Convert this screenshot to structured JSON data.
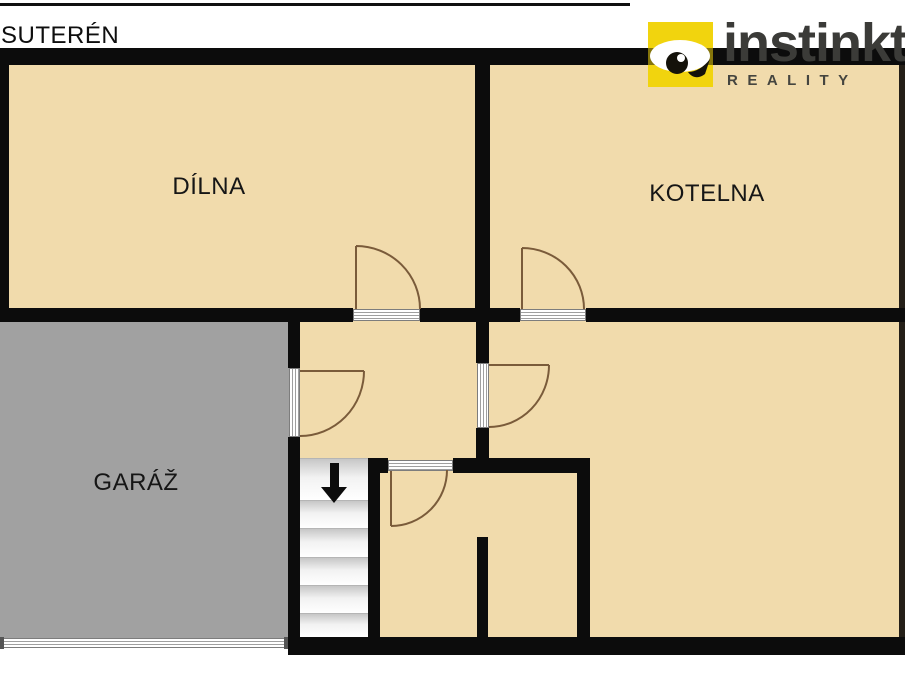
{
  "page": {
    "title": "SUTERÉN"
  },
  "logo": {
    "brand": "instinkt",
    "subtitle": "REALITY",
    "eye_icon": "eye-icon",
    "brand_color": "#3B3B38",
    "accent_yellow": "#F1D40E"
  },
  "floorplan": {
    "rooms": {
      "dilna": {
        "label": "DÍLNA"
      },
      "kotelna": {
        "label": "KOTELNA"
      },
      "garaz": {
        "label": "GARÁŽ"
      }
    },
    "stairs": {
      "direction": "down",
      "arrow_icon": "arrow-down-icon",
      "step_count": 6
    },
    "doors": {
      "count": 5,
      "swing_color": "#7A5B3A"
    },
    "colors": {
      "floor": "#F1DBAC",
      "garage_floor": "#A1A1A1",
      "wall": "#0C0C0C",
      "background": "#FFFFFF"
    }
  }
}
